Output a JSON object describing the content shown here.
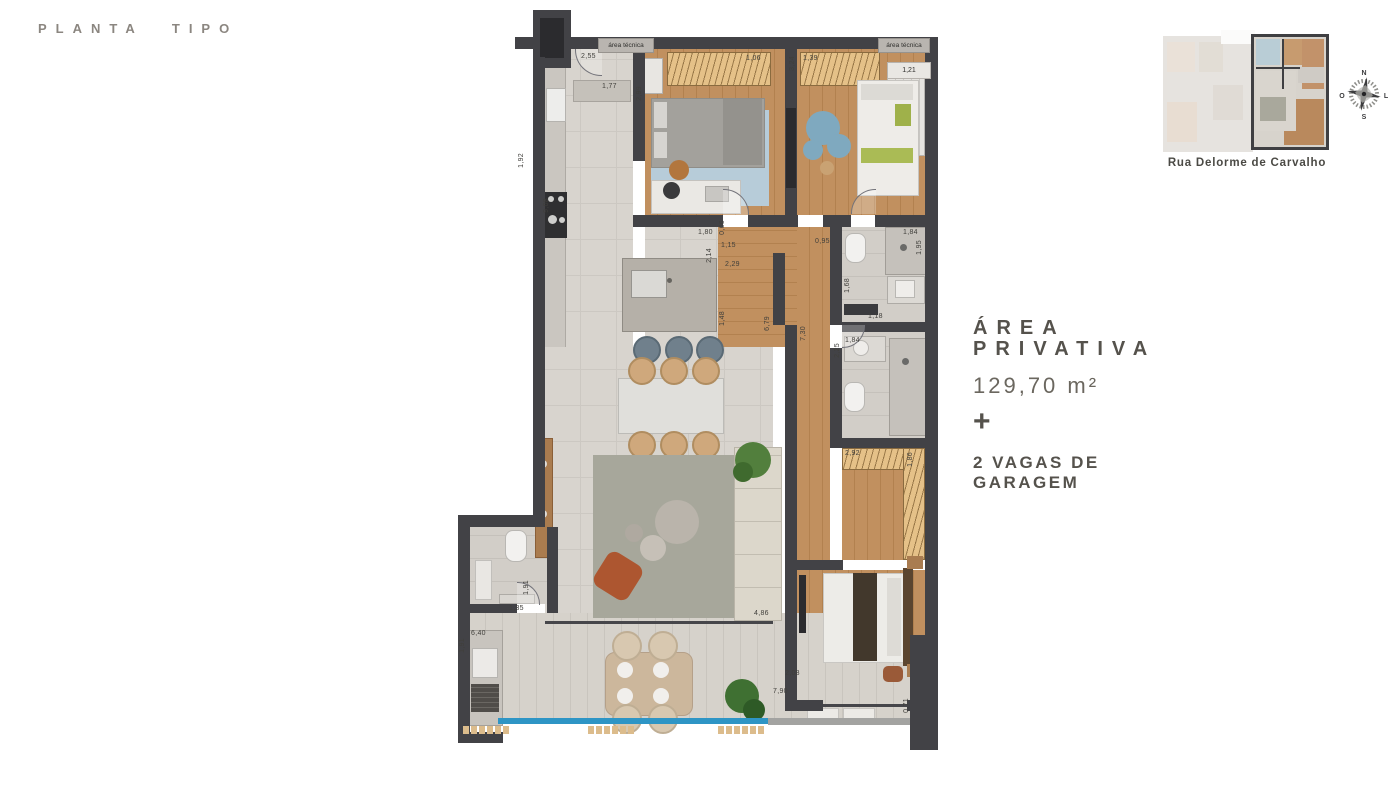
{
  "title": "PLANTA TIPO",
  "info": {
    "area_line1": "ÁREA",
    "area_line2": "PRIVATIVA",
    "area_value": "129,70 m²",
    "plus": "+",
    "garage_line1": "2 VAGAS DE",
    "garage_line2": "GARAGEM"
  },
  "keyplan": {
    "caption": "Rua Delorme de Carvalho",
    "compass": {
      "north": "N",
      "east": "L",
      "south": "S",
      "west": "O"
    }
  },
  "plan": {
    "tech_area_left": "área técnica",
    "tech_area_right": "área técnica",
    "tech_area_right_value": "1,21",
    "dims": [
      {
        "text": "2,55"
      },
      {
        "text": "1,77"
      },
      {
        "text": "2,99"
      },
      {
        "text": "1,06"
      },
      {
        "text": "1,39"
      },
      {
        "text": "1,21"
      },
      {
        "text": "1,92"
      },
      {
        "text": "9,08"
      },
      {
        "text": "1,80"
      },
      {
        "text": "2,14"
      },
      {
        "text": "0,66"
      },
      {
        "text": "1,15"
      },
      {
        "text": "2,29"
      },
      {
        "text": "1,48"
      },
      {
        "text": "6,79"
      },
      {
        "text": "7,30"
      },
      {
        "text": "0,95"
      },
      {
        "text": "1,84"
      },
      {
        "text": "1,95"
      },
      {
        "text": "1,68"
      },
      {
        "text": "1,18"
      },
      {
        "text": "1,84"
      },
      {
        "text": "2,25"
      },
      {
        "text": "2,92"
      },
      {
        "text": "1,86"
      },
      {
        "text": "4,86"
      },
      {
        "text": "1,91"
      },
      {
        "text": "1,35"
      },
      {
        "text": "6,40"
      },
      {
        "text": "1,91"
      },
      {
        "text": "2,08"
      },
      {
        "text": "7,90"
      },
      {
        "text": "0,71"
      },
      {
        "text": "3,24"
      }
    ]
  },
  "colors": {
    "wall": "#424246",
    "wood_floor": "#c1905f",
    "tile_floor": "#d8d4ce",
    "wardrobe_tan": "#e5c188",
    "railing_blue": "#2e95c5",
    "text_accent": "#55524c"
  }
}
